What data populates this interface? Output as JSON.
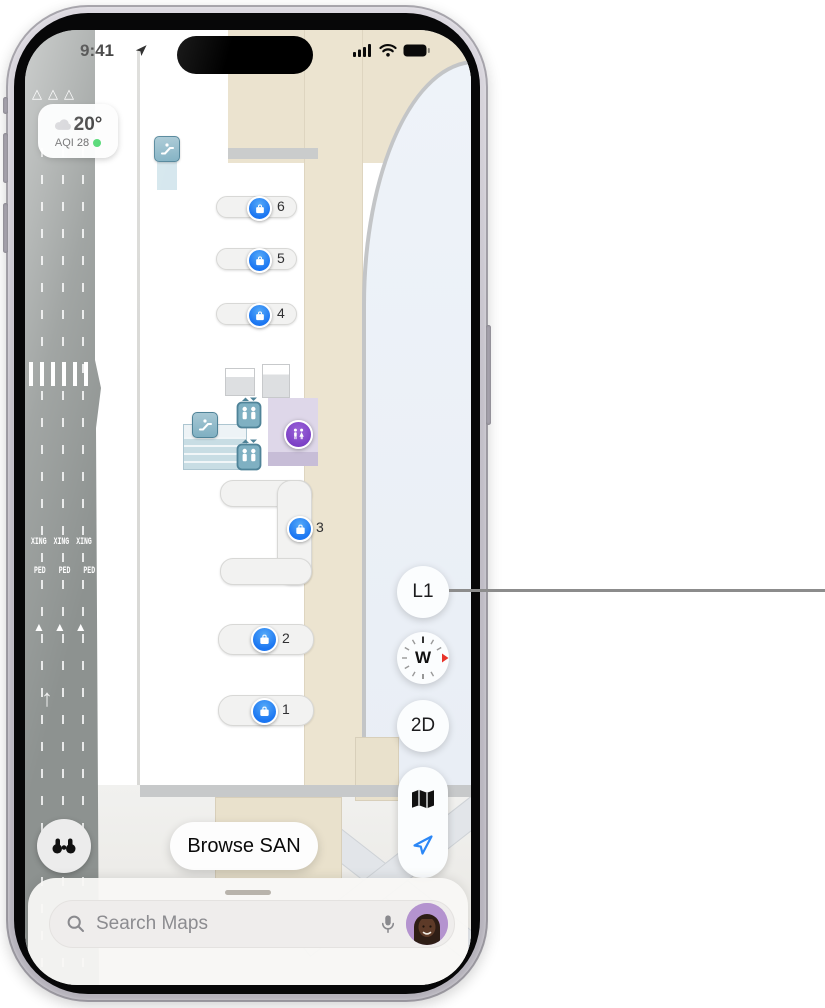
{
  "status_bar": {
    "time": "9:41"
  },
  "weather_widget": {
    "temperature": "20°",
    "aqi": "AQI 28"
  },
  "map": {
    "road_markings": {
      "xing": "XING",
      "ped": "PED",
      "chevron_outline": "△",
      "yield_triangle": "▲",
      "direction_arrow": "↑"
    },
    "baggage_carousels": [
      {
        "number": "6"
      },
      {
        "number": "5"
      },
      {
        "number": "4"
      },
      {
        "number": "3"
      },
      {
        "number": "2"
      },
      {
        "number": "1"
      }
    ]
  },
  "map_controls": {
    "floor_level": "L1",
    "compass_heading": "W",
    "view_mode": "2D"
  },
  "browse_button": {
    "label": "Browse SAN"
  },
  "search_bar": {
    "placeholder": "Search Maps"
  },
  "colors": {
    "marker_blue": "#1b76f2",
    "restroom_purple": "#8a4fd0",
    "transit_teal": "#7fb0c2",
    "road_gray": "#8d9290",
    "concourse_beige": "#ebe3cf",
    "aqi_green": "#30d158",
    "compass_north_red": "#e8332a",
    "location_blue": "#2b87f6"
  }
}
